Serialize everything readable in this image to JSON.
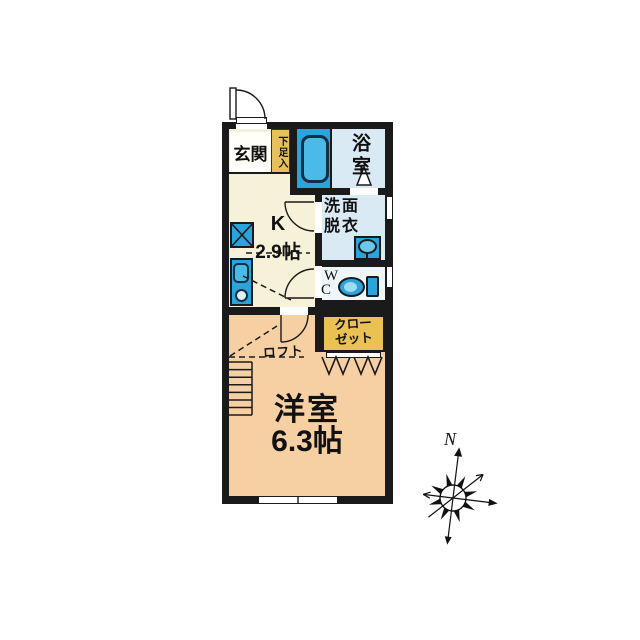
{
  "floorplan": {
    "genkan": {
      "label": "玄関"
    },
    "shoe_storage": {
      "label": "下足入"
    },
    "bathroom": {
      "label": "浴室"
    },
    "washroom": {
      "line1": "洗面",
      "line2": "脱衣"
    },
    "wc": {
      "line1": "W",
      "line2": "C"
    },
    "kitchen": {
      "type": "K",
      "size": "2.9帖"
    },
    "closet": {
      "line1": "クロー",
      "line2": "ゼット"
    },
    "loft": {
      "label": "ロフト"
    },
    "western_room": {
      "name": "洋室",
      "size": "6.3帖"
    },
    "compass": {
      "north": "N"
    },
    "colors": {
      "wall": "#1a1a1a",
      "cream": "#f6f2d9",
      "gold_shoe": "#e7c05e",
      "gold_closet": "#eac253",
      "peach": "#f6cfa3",
      "light_blue": "#d9eaf4",
      "fixture_blue": "#2ba3db",
      "tub_blue": "#4abae6",
      "wc_floor": "#eff6fa"
    }
  }
}
